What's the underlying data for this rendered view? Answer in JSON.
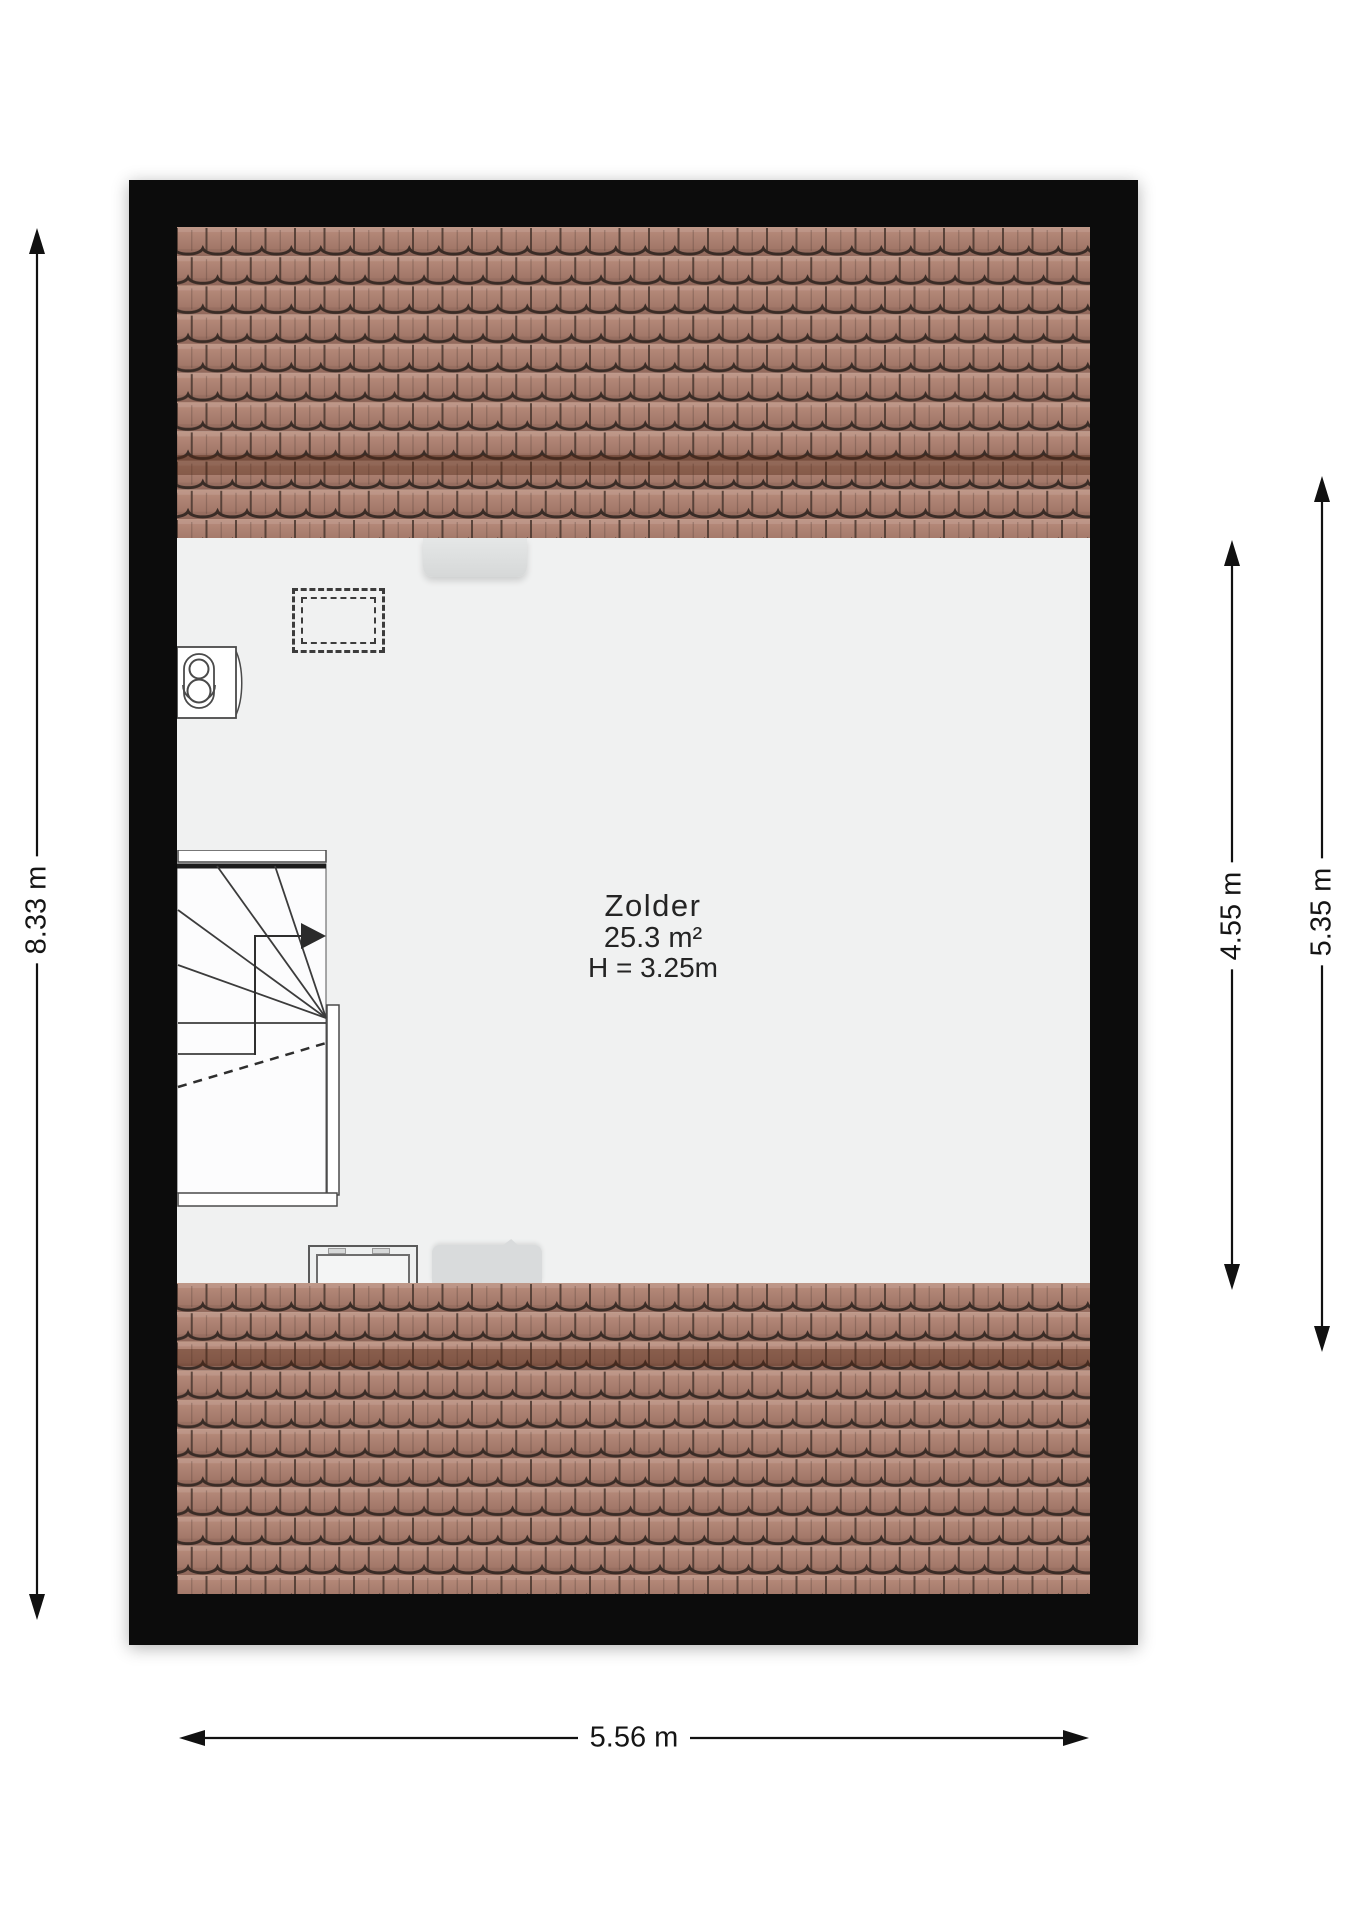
{
  "room": {
    "name": "Zolder",
    "area": "25.3 m²",
    "ceiling_height": "H = 3.25m"
  },
  "dimensions": {
    "left": "8.33 m",
    "right_inner": "4.55 m",
    "right_outer": "5.35 m",
    "bottom": "5.56 m"
  },
  "colors": {
    "wall": "#0c0c0c",
    "floor": "#f0f1f1",
    "tile_body": "#ab7e70",
    "tile_joint": "#4a372f",
    "ridge_overlay": "#542816",
    "dimension_line": "#111111"
  },
  "symbols": {
    "stairs": "stairs-symbol",
    "walk_arrow": "walk-direction-arrow-icon",
    "boiler": "boiler-symbol",
    "skylight": "skylight-dashed",
    "roof_window_top": "roof-window-top",
    "window_bottom": "window-frame-bottom",
    "roof_window_bottom": "roof-window-bottom"
  }
}
